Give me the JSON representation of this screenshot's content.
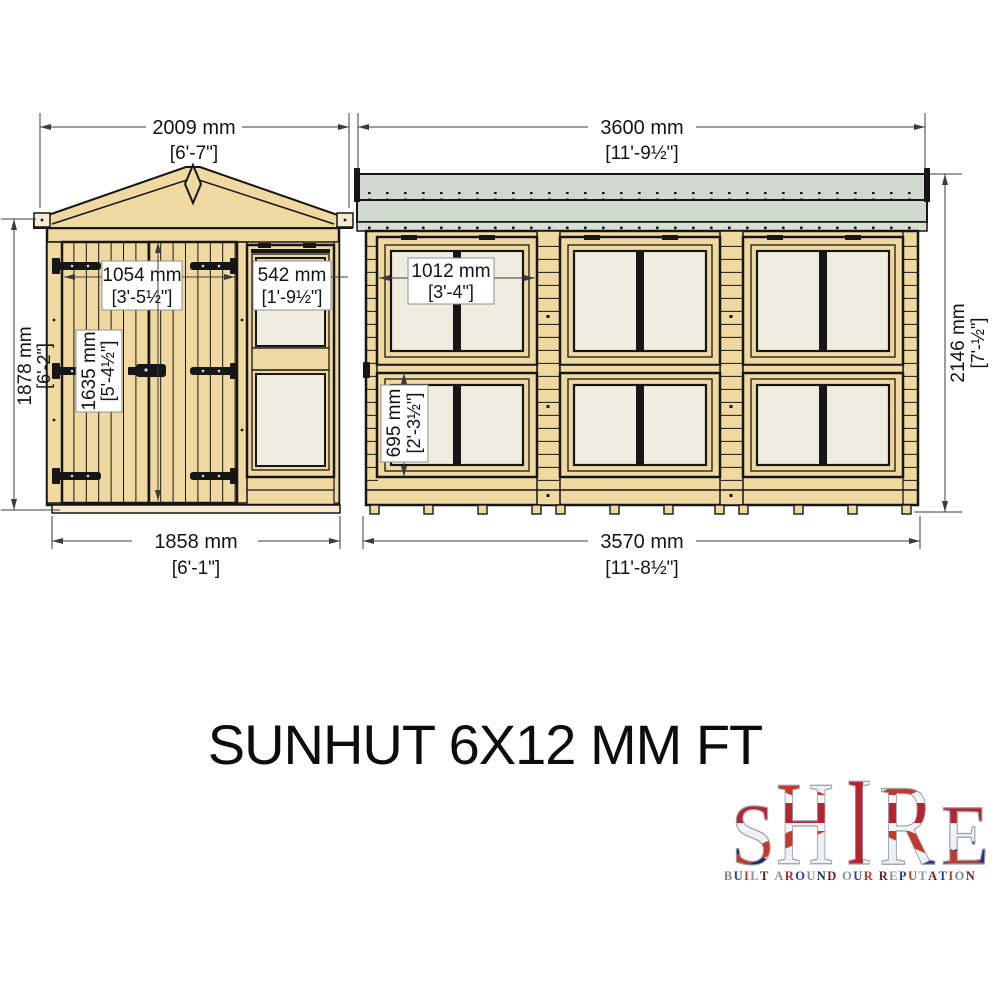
{
  "title": "SUNHUT 6X12 MM FT",
  "dims": {
    "front_width": {
      "mm": "2009 mm",
      "ft": "[6'-7\"]"
    },
    "front_height": {
      "mm": "1878 mm",
      "ft": "[6'-2\"]"
    },
    "door_width": {
      "mm": "1054 mm",
      "ft": "[3'-5½\"]"
    },
    "front_window_width": {
      "mm": "542 mm",
      "ft": "[1'-9½\"]"
    },
    "door_height": {
      "mm": "1635 mm",
      "ft": "[5'-4½\"]"
    },
    "front_base_width": {
      "mm": "1858 mm",
      "ft": "[6'-1\"]"
    },
    "side_width": {
      "mm": "3600 mm",
      "ft": "[11'-9½\"]"
    },
    "side_height": {
      "mm": "2146 mm",
      "ft": "[7'-½\"]"
    },
    "side_window_width": {
      "mm": "1012 mm",
      "ft": "[3'-4\"]"
    },
    "side_window_height": {
      "mm": "695 mm",
      "ft": "[2'-3½\"]"
    },
    "side_base_width": {
      "mm": "3570 mm",
      "ft": "[11'-8½\"]"
    }
  },
  "logo": {
    "name": "SHIRE",
    "letters": [
      "S",
      "H",
      "I",
      "R",
      "E"
    ],
    "tagline": "BUILT AROUND OUR REPUTATION",
    "tagline_colors": [
      "#7d838d",
      "#2c3f8f",
      "#bf3a2c",
      "#8a8f98",
      "#5f1d26",
      null,
      "#8a8f98",
      "#a82e24",
      "#2c3f8f",
      "#8a8f98",
      "#1d2b6b",
      "#6f2026",
      null,
      "#8a8f98",
      "#2c3f8f",
      "#bf3a2c",
      null,
      "#6f2026",
      "#8a8f98",
      "#2c3f8f",
      "#bf3a2c",
      "#8a8f98",
      "#6f2026",
      "#2c3f8f",
      "#bf3a2c",
      "#7d838d",
      "#6f2026"
    ]
  },
  "colors": {
    "page_bg": "#ffffff",
    "wood": "#f0d9a0",
    "wood_light": "#f6ead0",
    "outline": "#161616",
    "glass": "#f0ecdf",
    "glass_shade": "#ded9c7",
    "roof": "#cfd9cd",
    "roof_strip": "#dadfd6",
    "dim_line": "#3c3c3c",
    "text": "#141414",
    "label_border": "#8f8f8f",
    "logo_red": "#b42431",
    "logo_blue": "#26337f"
  }
}
